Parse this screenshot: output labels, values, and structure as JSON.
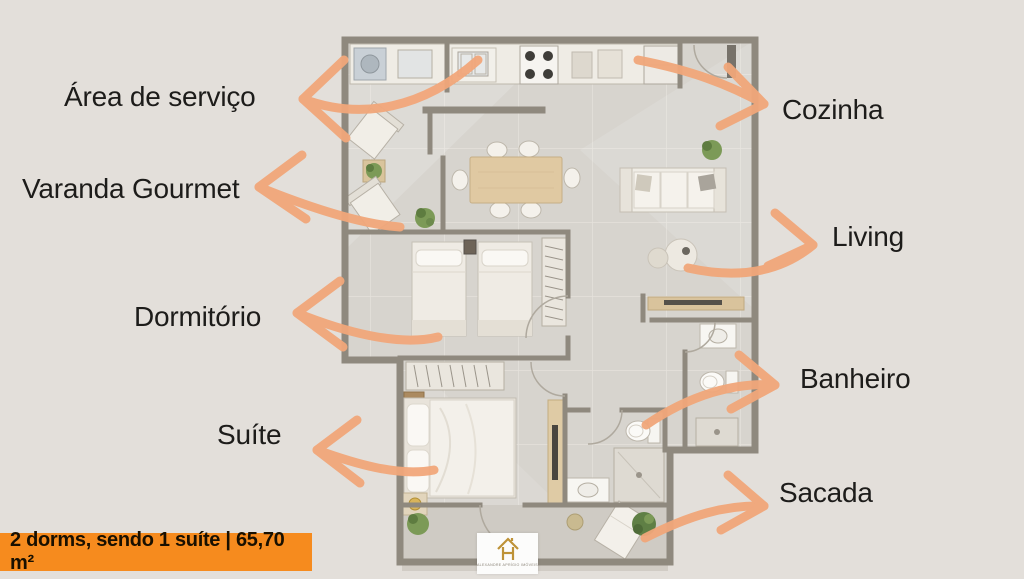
{
  "rooms": {
    "area_servico": {
      "label": "Área de serviço"
    },
    "varanda": {
      "label": "Varanda Gourmet"
    },
    "dormitorio": {
      "label": "Dormitório"
    },
    "suite": {
      "label": "Suíte"
    },
    "cozinha": {
      "label": "Cozinha"
    },
    "living": {
      "label": "Living"
    },
    "banheiro": {
      "label": "Banheiro"
    },
    "sacada": {
      "label": "Sacada"
    }
  },
  "banner": {
    "text": "2 dorms, sendo 1 suíte | 65,70 m²"
  },
  "logo": {
    "company": "ALEXANDRE APRÍGIO IMÓVEIS",
    "icon": "house-logo-icon"
  },
  "colors": {
    "background": "#E3DFDA",
    "arrow": "#F1A77A",
    "banner_bg": "#F68B1E",
    "label_text": "#1D1C1A",
    "wall": "#8F897E",
    "floor": "#D7D4CE",
    "logo_gold": "#BE9237"
  }
}
